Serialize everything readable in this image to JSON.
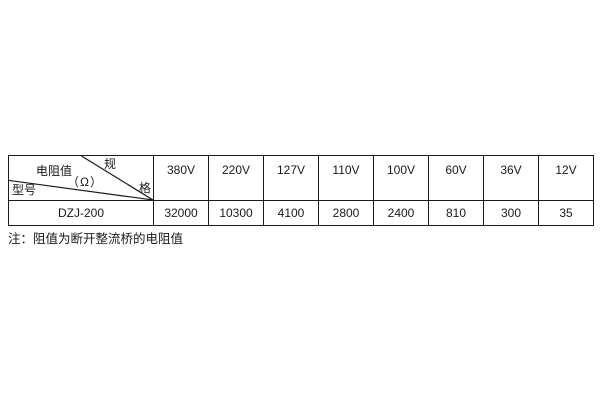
{
  "colors": {
    "border": "#1a1a1a",
    "text": "#1a1a1a",
    "background": "#ffffff"
  },
  "table": {
    "header_corner": {
      "spec_label_char1": "规",
      "spec_label_char2": "格",
      "resistance_label": "电阻值",
      "resistance_unit": "（Ω）",
      "model_label": "型号"
    },
    "voltage_columns": [
      "380V",
      "220V",
      "127V",
      "110V",
      "100V",
      "60V",
      "36V",
      "12V"
    ],
    "rows": [
      {
        "model": "DZJ-200",
        "values": [
          "32000",
          "10300",
          "4100",
          "2800",
          "2400",
          "810",
          "300",
          "35"
        ]
      }
    ]
  },
  "note": "注：阻值为断开整流桥的电阻值"
}
